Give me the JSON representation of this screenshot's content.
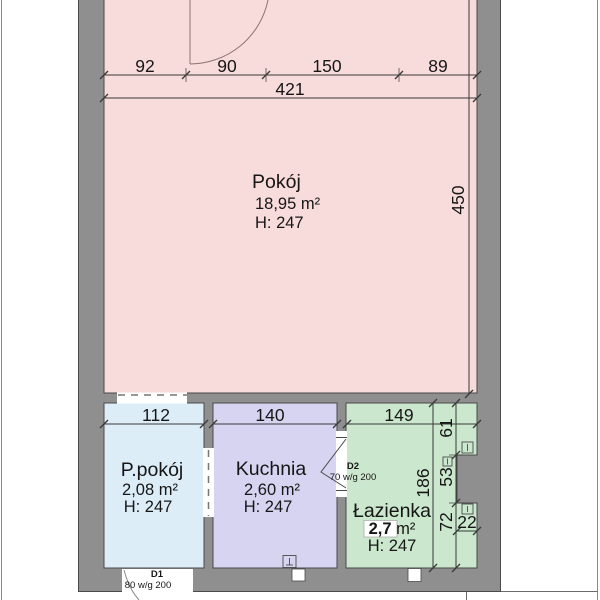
{
  "floor_plan": {
    "rooms": {
      "pokoj": {
        "name": "Pokój",
        "area": "18,95 m²",
        "height": "H: 247",
        "color": "#f8dbdb"
      },
      "ppokoj": {
        "name": "P.pokój",
        "area": "2,08 m²",
        "height": "H: 247",
        "color": "#ddedf8"
      },
      "kuchnia": {
        "name": "Kuchnia",
        "area": "2,60 m²",
        "height": "H: 247",
        "color": "#d6d4f0"
      },
      "lazienka": {
        "name": "Łazienka",
        "area_value": "2,7",
        "area_unit": " m²",
        "height": "H: 247",
        "color": "#cbe7cd"
      }
    },
    "dim_labels": {
      "seg1": "92",
      "seg2": "90",
      "seg3": "150",
      "seg4": "89",
      "total_width": "421",
      "room_height": "450",
      "ppokoj_width": "112",
      "kuchnia_width": "140",
      "lazienka_width": "149",
      "bath_a": "61",
      "bath_b": "53",
      "bath_c": "72",
      "bath_total": "186",
      "bath_recess": "22"
    },
    "doors": {
      "d1": {
        "label": "D1",
        "spec": "80 w/g 200"
      },
      "d2": {
        "label": "D2",
        "spec": "70 w/g 200"
      }
    },
    "colors": {
      "wall": "#8f8f8f",
      "outline": "#4a4a4a",
      "dim_line": "#3a3a3a"
    }
  }
}
